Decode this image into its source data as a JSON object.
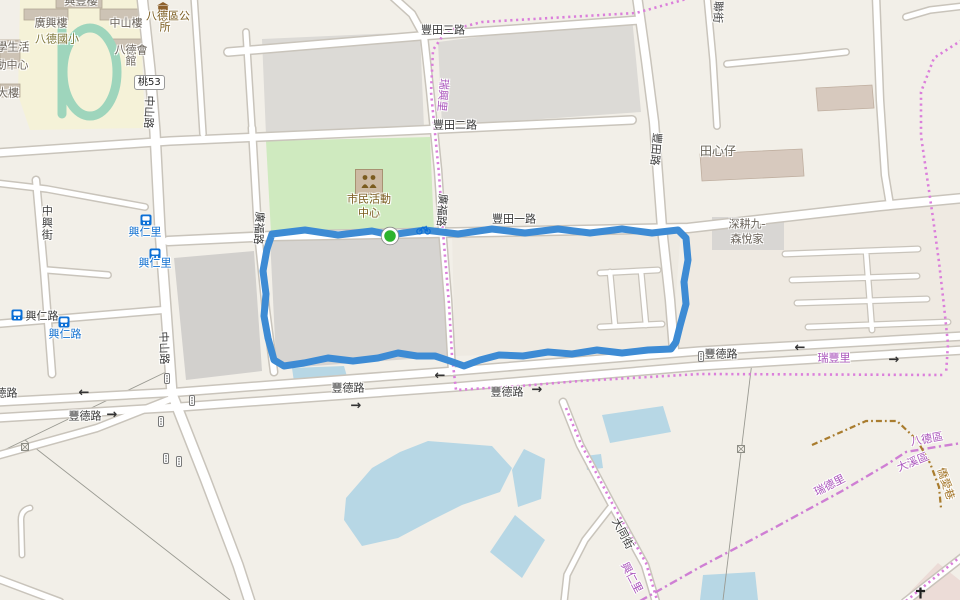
{
  "map": {
    "title": "Bade District street map with GPS running route",
    "background_color": "#f2efe8",
    "route": {
      "color": "#3d8bd4",
      "start_marker_color": "#2db32d",
      "shape": "closed loop along 豐田一路 / 豐田路 / 豐德路 block"
    },
    "road_ref_badge": {
      "text": "桃53"
    },
    "labels": [
      {
        "t": "興豐樓",
        "x": 81,
        "y": 2,
        "k": "building"
      },
      {
        "t": "廣興樓",
        "x": 51,
        "y": 24,
        "k": "building"
      },
      {
        "t": "中山樓",
        "x": 126,
        "y": 24,
        "k": "building"
      },
      {
        "t": "八德區公",
        "x": 168,
        "y": 17,
        "k": "amenity"
      },
      {
        "t": "所",
        "x": 165,
        "y": 28,
        "k": "amenity"
      },
      {
        "t": "八德國小",
        "x": 57,
        "y": 40,
        "k": "school"
      },
      {
        "t": "八德會",
        "x": 131,
        "y": 51,
        "k": "building"
      },
      {
        "t": "館",
        "x": 131,
        "y": 62,
        "k": "building"
      },
      {
        "t": "學生活",
        "x": 13,
        "y": 48,
        "k": "building"
      },
      {
        "t": "動中心",
        "x": 12,
        "y": 66,
        "k": "building"
      },
      {
        "t": "大樓",
        "x": 8,
        "y": 94,
        "k": "building"
      },
      {
        "t": "中山路",
        "x": 148,
        "y": 112,
        "k": "road",
        "r": 92
      },
      {
        "t": "中山路",
        "x": 163,
        "y": 348,
        "k": "road",
        "r": 88
      },
      {
        "t": "中興街",
        "x": 46,
        "y": 223,
        "k": "road",
        "vert": true
      },
      {
        "t": "興仁里",
        "x": 145,
        "y": 233,
        "k": "bus"
      },
      {
        "t": "興仁里",
        "x": 155,
        "y": 264,
        "k": "bus"
      },
      {
        "t": "興仁路",
        "x": 42,
        "y": 317,
        "k": "road"
      },
      {
        "t": "興仁路",
        "x": 65,
        "y": 335,
        "k": "bus"
      },
      {
        "t": "豐田三路",
        "x": 443,
        "y": 31,
        "k": "road"
      },
      {
        "t": "豐田二路",
        "x": 455,
        "y": 126,
        "k": "road"
      },
      {
        "t": "豐田一路",
        "x": 514,
        "y": 220,
        "k": "road"
      },
      {
        "t": "豐田路",
        "x": 655,
        "y": 149,
        "k": "road",
        "r": 95
      },
      {
        "t": "聯街",
        "x": 717,
        "y": 12,
        "k": "road",
        "r": 92
      },
      {
        "t": "田心仔",
        "x": 718,
        "y": 152,
        "k": "place"
      },
      {
        "t": "深耕九-",
        "x": 747,
        "y": 225,
        "k": "building"
      },
      {
        "t": "森悅家",
        "x": 747,
        "y": 240,
        "k": "building"
      },
      {
        "t": "市民活動",
        "x": 369,
        "y": 200,
        "k": "amenity"
      },
      {
        "t": "中心",
        "x": 369,
        "y": 214,
        "k": "amenity"
      },
      {
        "t": "廣福路",
        "x": 258,
        "y": 228,
        "k": "road",
        "r": 93
      },
      {
        "t": "廣福路",
        "x": 441,
        "y": 210,
        "k": "road",
        "r": 94
      },
      {
        "t": "瑞興里",
        "x": 442,
        "y": 95,
        "k": "boundary",
        "r": 95
      },
      {
        "t": "豐德路",
        "x": 1,
        "y": 394,
        "k": "road"
      },
      {
        "t": "豐德路",
        "x": 85,
        "y": 417,
        "k": "road"
      },
      {
        "t": "豐德路",
        "x": 348,
        "y": 389,
        "k": "road"
      },
      {
        "t": "豐德路",
        "x": 507,
        "y": 393,
        "k": "road"
      },
      {
        "t": "豐德路",
        "x": 721,
        "y": 355,
        "k": "road"
      },
      {
        "t": "瑞豐里",
        "x": 834,
        "y": 359,
        "k": "boundary"
      },
      {
        "t": "大同街",
        "x": 622,
        "y": 534,
        "k": "road",
        "r": 62
      },
      {
        "t": "興仁里",
        "x": 631,
        "y": 578,
        "k": "boundary",
        "r": 62
      },
      {
        "t": "瑞德里",
        "x": 830,
        "y": 486,
        "k": "boundary",
        "r": -27
      },
      {
        "t": "大溪區",
        "x": 913,
        "y": 463,
        "k": "boundary",
        "r": -22
      },
      {
        "t": "八德區",
        "x": 927,
        "y": 440,
        "k": "boundary",
        "r": -10
      },
      {
        "t": "僑愛巷",
        "x": 945,
        "y": 484,
        "k": "district",
        "r": 72
      },
      {
        "t": "←",
        "x": 84,
        "y": 394,
        "k": "arrow"
      },
      {
        "t": "→",
        "x": 112,
        "y": 416,
        "k": "arrow"
      },
      {
        "t": "→",
        "x": 356,
        "y": 407,
        "k": "arrow"
      },
      {
        "t": "←",
        "x": 440,
        "y": 377,
        "k": "arrow"
      },
      {
        "t": "→",
        "x": 537,
        "y": 391,
        "k": "arrow"
      },
      {
        "t": "←",
        "x": 800,
        "y": 349,
        "k": "arrow"
      },
      {
        "t": "→",
        "x": 894,
        "y": 361,
        "k": "arrow"
      }
    ],
    "icons": [
      {
        "type": "bus-stop",
        "x": 140,
        "y": 211
      },
      {
        "type": "bus-stop",
        "x": 149,
        "y": 245
      },
      {
        "type": "bus-stop",
        "x": 11,
        "y": 306
      },
      {
        "type": "bus-stop",
        "x": 58,
        "y": 313
      },
      {
        "type": "bicycle",
        "x": 416,
        "y": 220
      },
      {
        "type": "community-centre",
        "x": 355,
        "y": 169
      },
      {
        "type": "town-hall",
        "x": 156,
        "y": -2
      },
      {
        "type": "traffic-light",
        "x": 164,
        "y": 369
      },
      {
        "type": "traffic-light",
        "x": 189,
        "y": 391
      },
      {
        "type": "traffic-light",
        "x": 158,
        "y": 412
      },
      {
        "type": "traffic-light",
        "x": 163,
        "y": 449
      },
      {
        "type": "traffic-light",
        "x": 176,
        "y": 452
      },
      {
        "type": "traffic-light",
        "x": 698,
        "y": 347
      },
      {
        "type": "power-pole",
        "x": 21,
        "y": 436
      },
      {
        "type": "power-pole",
        "x": 737,
        "y": 438
      },
      {
        "type": "cross",
        "x": 915,
        "y": 584
      }
    ]
  }
}
